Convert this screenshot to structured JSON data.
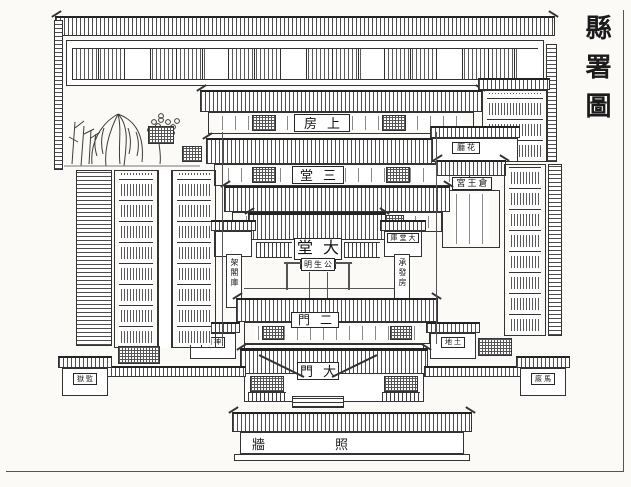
{
  "page": {
    "colors": {
      "paper": "#fbfaf6",
      "ink": "#2b2b2b",
      "hatch": "#555555"
    }
  },
  "labels": {
    "title": "縣署圖",
    "shangfang": "房上",
    "santang": "堂三",
    "ertang": "堂二",
    "datang": "堂大",
    "gongshengming": "明生公",
    "ermen": "門二",
    "damen": "門大",
    "zhaoqiang_left": "牆",
    "zhaoqiang_right": "照",
    "cangwanggong": "宮王倉",
    "datangku": "庫堂大",
    "huating": "廳花",
    "corridor_left": "架閣庫",
    "corridor_right": "承發房",
    "shrine_left": "祠神",
    "shrine_right": "地土",
    "corner_left": "獄監",
    "corner_right": "廄馬"
  }
}
